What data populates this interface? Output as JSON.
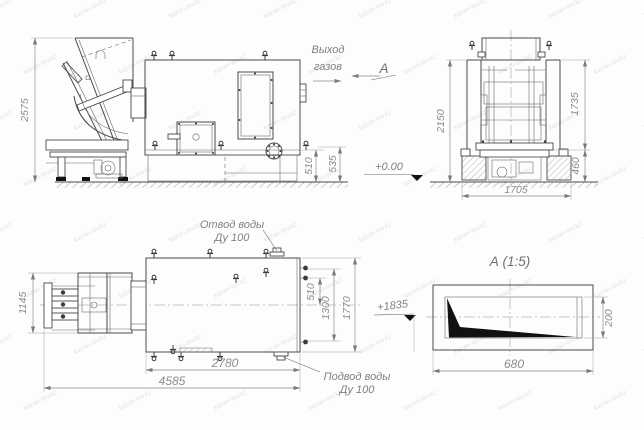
{
  "labels": {
    "gas_outlet": [
      "Выход",
      "газов"
    ],
    "view_marker": "А",
    "water_outlet": [
      "Отвод воды",
      "Ду 100"
    ],
    "water_inlet": [
      "Подвод воды",
      "Ду 100"
    ],
    "level_zero": "+0.00",
    "level_1835": "+1835"
  },
  "detail": {
    "title": "А (1:5)"
  },
  "dims": {
    "side_height": "2575",
    "side_510": "510",
    "side_535": "535",
    "front_height": "2150",
    "front_1735": "1735",
    "front_460": "460",
    "front_1705": "1705",
    "plan_1145": "1145",
    "plan_2780": "2780",
    "plan_4585": "4585",
    "plan_510": "510",
    "plan_1300": "1300",
    "plan_1770": "1770",
    "detail_680": "680",
    "detail_200": "200"
  },
  "watermark": {
    "text": "kazan-tev.kz"
  }
}
